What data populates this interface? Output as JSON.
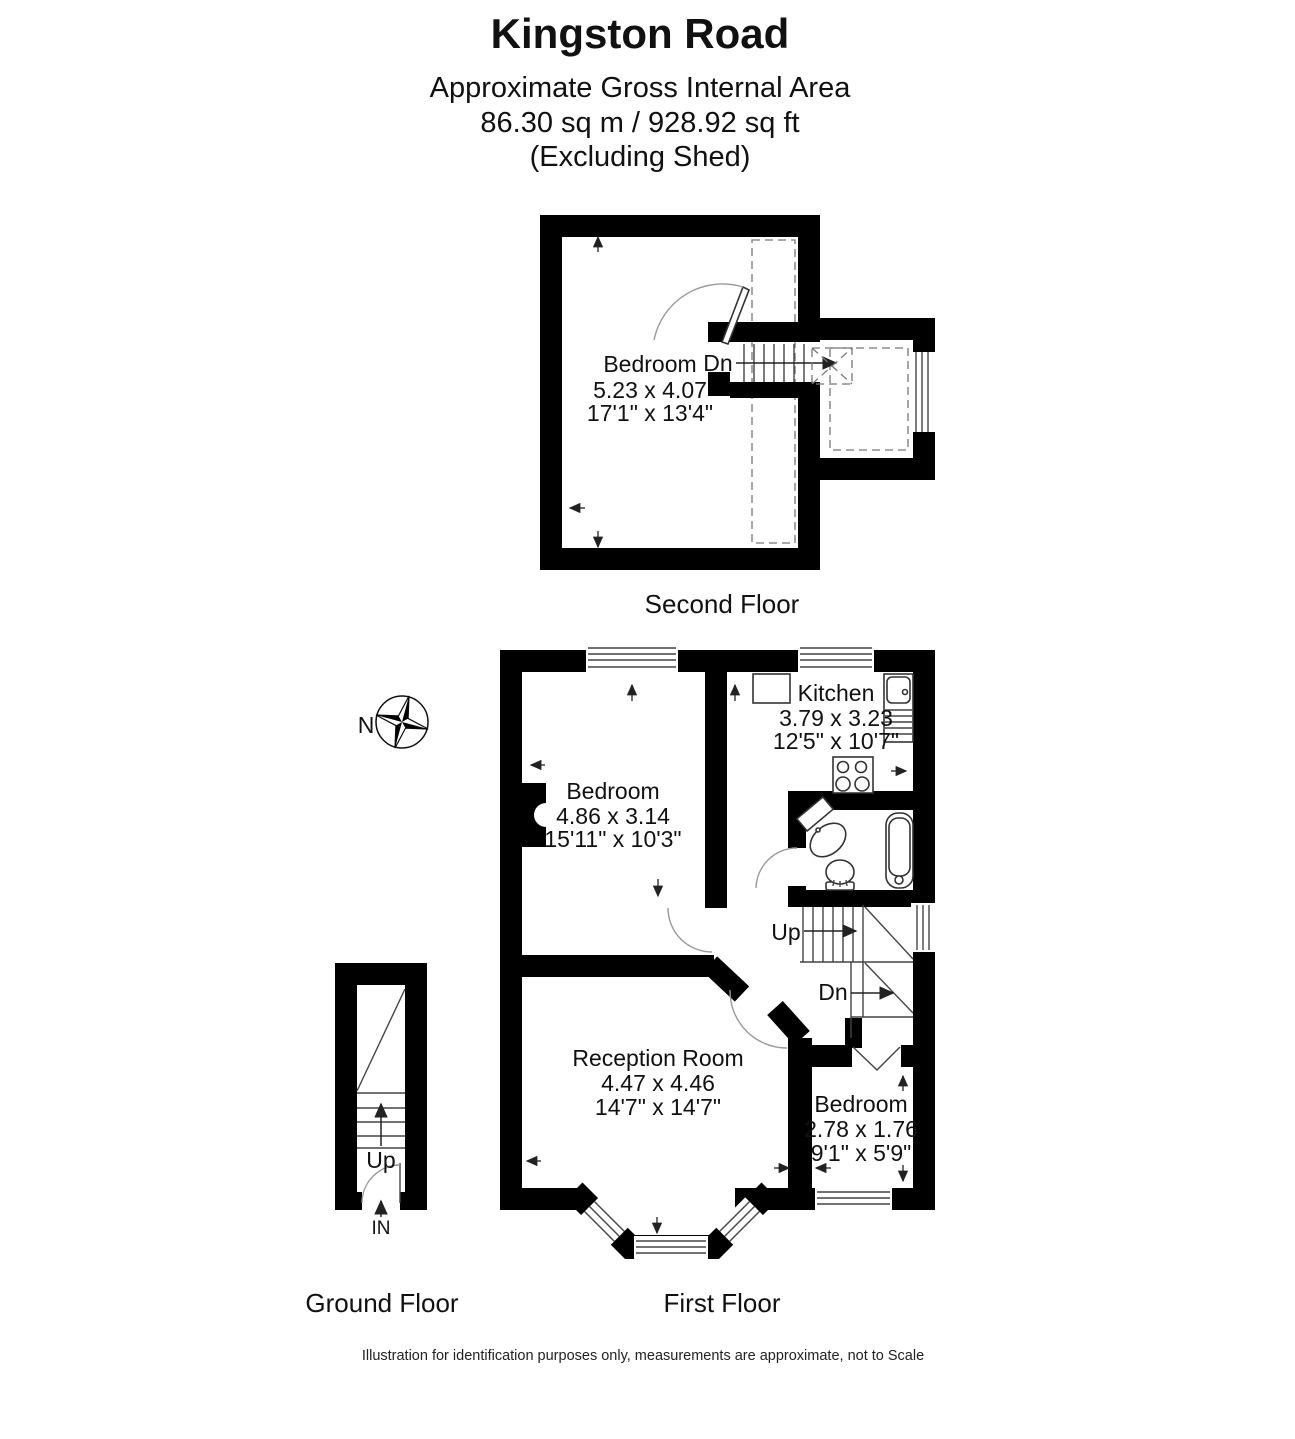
{
  "title": {
    "name": "Kingston Road",
    "subtitle": "Approximate Gross Internal Area",
    "area": "86.30 sq m / 928.92 sq ft",
    "note": "(Excluding Shed)"
  },
  "second_floor": {
    "label": "Second Floor",
    "room": {
      "name": "Bedroom",
      "metric": "5.23 x 4.07",
      "imperial": "17'1\" x 13'4\""
    },
    "stairs": {
      "down": "Dn"
    }
  },
  "first_floor": {
    "label": "First Floor",
    "kitchen": {
      "name": "Kitchen",
      "metric": "3.79 x 3.23",
      "imperial": "12'5\" x 10'7\""
    },
    "bedroom": {
      "name": "Bedroom",
      "metric": "4.86 x 3.14",
      "imperial": "15'11\" x 10'3\""
    },
    "reception": {
      "name": "Reception Room",
      "metric": "4.47 x 4.46",
      "imperial": "14'7\" x 14'7\""
    },
    "bedroom_small": {
      "name": "Bedroom",
      "metric": "2.78 x 1.76",
      "imperial": "9'1\" x 5'9\""
    },
    "stairs": {
      "up": "Up",
      "down": "Dn"
    }
  },
  "ground_floor": {
    "label": "Ground Floor",
    "stairs": {
      "up": "Up"
    },
    "entrance": "IN"
  },
  "compass": {
    "north": "N"
  },
  "footer": {
    "disclaimer": "Illustration for identification purposes only, measurements are approximate, not to Scale"
  },
  "colors": {
    "wall": "#000000",
    "background": "#ffffff",
    "fixture_line": "#333333",
    "door_arc": "#999999"
  }
}
